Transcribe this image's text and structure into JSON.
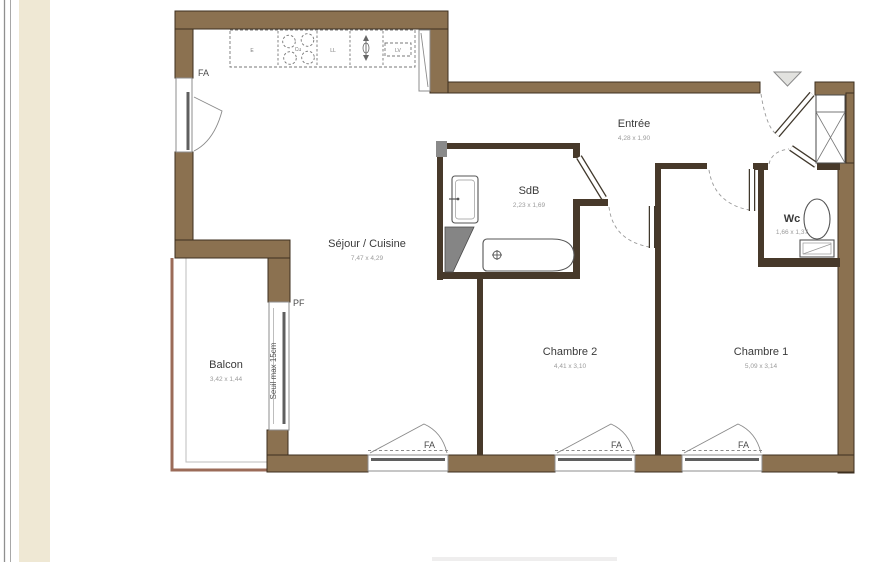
{
  "plan": {
    "rooms": {
      "sejour": {
        "name": "Séjour / Cuisine",
        "dims": "7,47 x 4,29"
      },
      "balcon": {
        "name": "Balcon",
        "dims": "3,42 x 1,44"
      },
      "entree": {
        "name": "Entrée",
        "dims": "4,28 x 1,90"
      },
      "sdb": {
        "name": "SdB",
        "dims": "2,23 x 1,69"
      },
      "wc": {
        "name": "Wc",
        "dims": "1,66 x 1,37"
      },
      "chambre2": {
        "name": "Chambre 2",
        "dims": "4,41 x 3,10"
      },
      "chambre1": {
        "name": "Chambre 1",
        "dims": "5,09 x 3,14"
      }
    },
    "labels": {
      "window_fa": "FA",
      "window_pf": "PF",
      "seuil": "Seuil max 15cm"
    },
    "kitchen": {
      "sink": "E",
      "hob": "Cu",
      "washing_machine": "LL",
      "dishwasher": "LV"
    },
    "colors": {
      "wall": "#8B7150",
      "wall_outline": "#3D2F1F",
      "partition": "#47392A",
      "balcony_outline": "#9B6B58",
      "page_stripe": "#EFE8D4",
      "room_text": "#3A3A3A",
      "dim_text": "#9B9B9B"
    }
  }
}
